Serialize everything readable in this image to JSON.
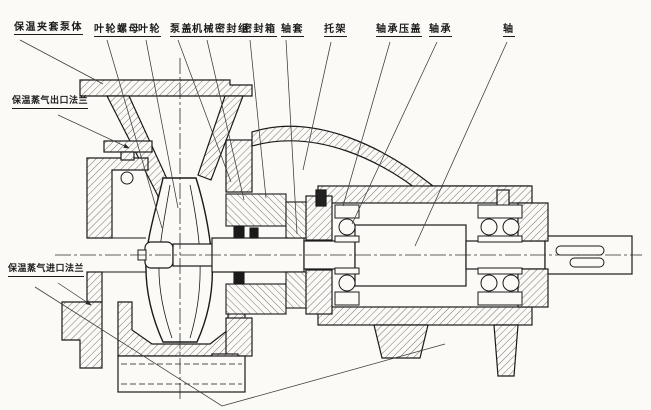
{
  "figure": {
    "description_colors": {
      "paper": "#fbfaf6",
      "ink": "#1a1a1a",
      "leader": "#3a3a3a"
    }
  },
  "labels": {
    "top": [
      "保温夹套泵体",
      "叶轮螺母",
      "叶轮",
      "泵盖",
      "机械密封组",
      "密封箱",
      "轴套",
      "托架",
      "轴承压盖",
      "轴承",
      "轴"
    ],
    "left": [
      "保温蒸气出口法兰",
      "保温蒸气进口法兰"
    ]
  }
}
